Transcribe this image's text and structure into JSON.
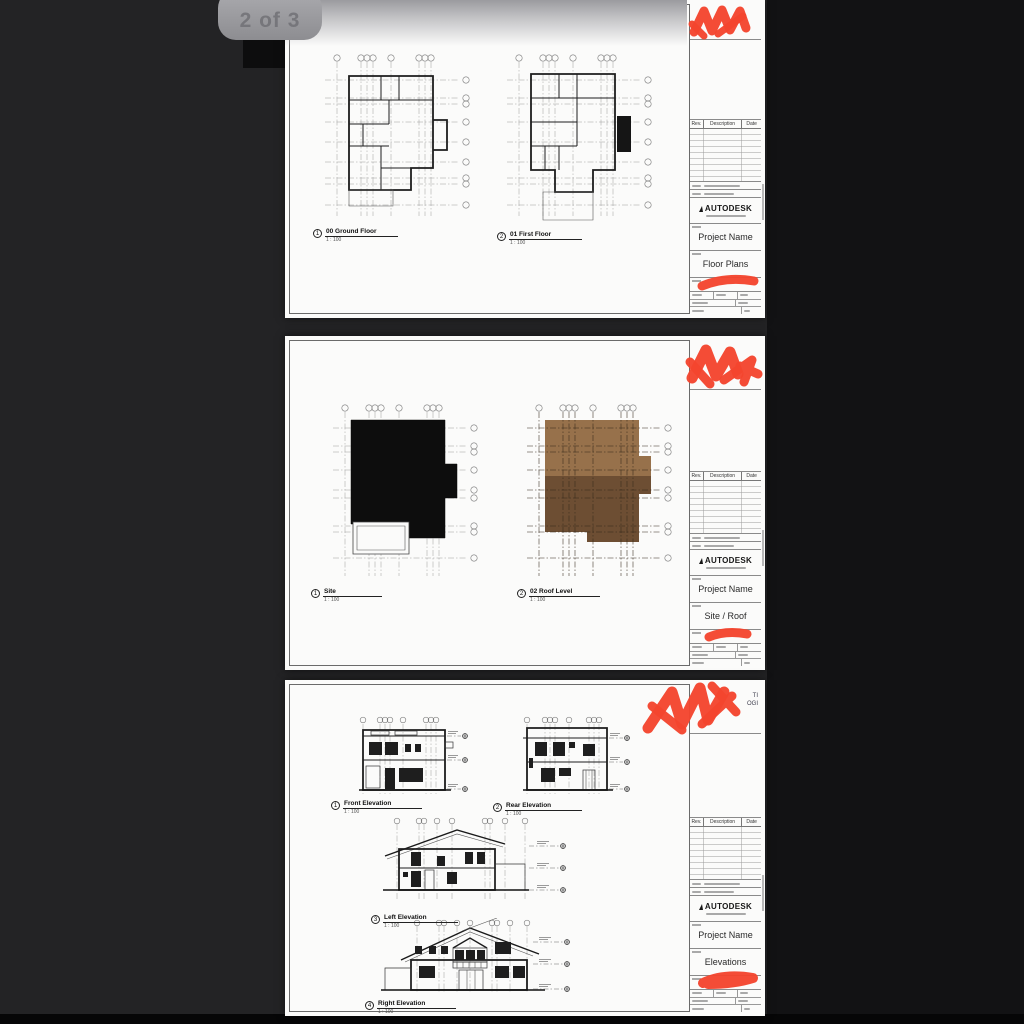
{
  "page_indicator": {
    "label": "2 of 3"
  },
  "brand": {
    "name": "AUTODESK"
  },
  "revision_table": {
    "rev": "Rev.",
    "description": "Description",
    "date": "Date"
  },
  "colors": {
    "background": "#232325",
    "sheet": "#fbfbfa",
    "scribble_red": "#f4452e",
    "site_mass_black": "#0d0d0d",
    "roof_light_brown": "#97714b",
    "roof_dark_brown": "#6d4e33",
    "badge_gray": "#9a9a9e"
  },
  "sheets": [
    {
      "project_name": "Project Name",
      "sheet_title": "Floor Plans",
      "drawings": [
        {
          "number": "1",
          "label": "00 Ground Floor",
          "scale": "1 : 100"
        },
        {
          "number": "2",
          "label": "01 First Floor",
          "scale": "1 : 100"
        }
      ]
    },
    {
      "project_name": "Project Name",
      "sheet_title": "Site / Roof",
      "drawings": [
        {
          "number": "1",
          "label": "Site",
          "scale": "1 : 100"
        },
        {
          "number": "2",
          "label": "02 Roof Level",
          "scale": "1 : 100"
        }
      ]
    },
    {
      "project_name": "Project Name",
      "sheet_title": "Elevations",
      "logo_fragments": [
        "TI",
        "OGI"
      ],
      "drawings": [
        {
          "number": "1",
          "label": "Front Elevation",
          "scale": "1 : 100"
        },
        {
          "number": "2",
          "label": "Rear Elevation",
          "scale": "1 : 100"
        },
        {
          "number": "3",
          "label": "Left Elevation",
          "scale": "1 : 100"
        },
        {
          "number": "4",
          "label": "Right Elevation",
          "scale": "1 : 100"
        }
      ]
    }
  ]
}
